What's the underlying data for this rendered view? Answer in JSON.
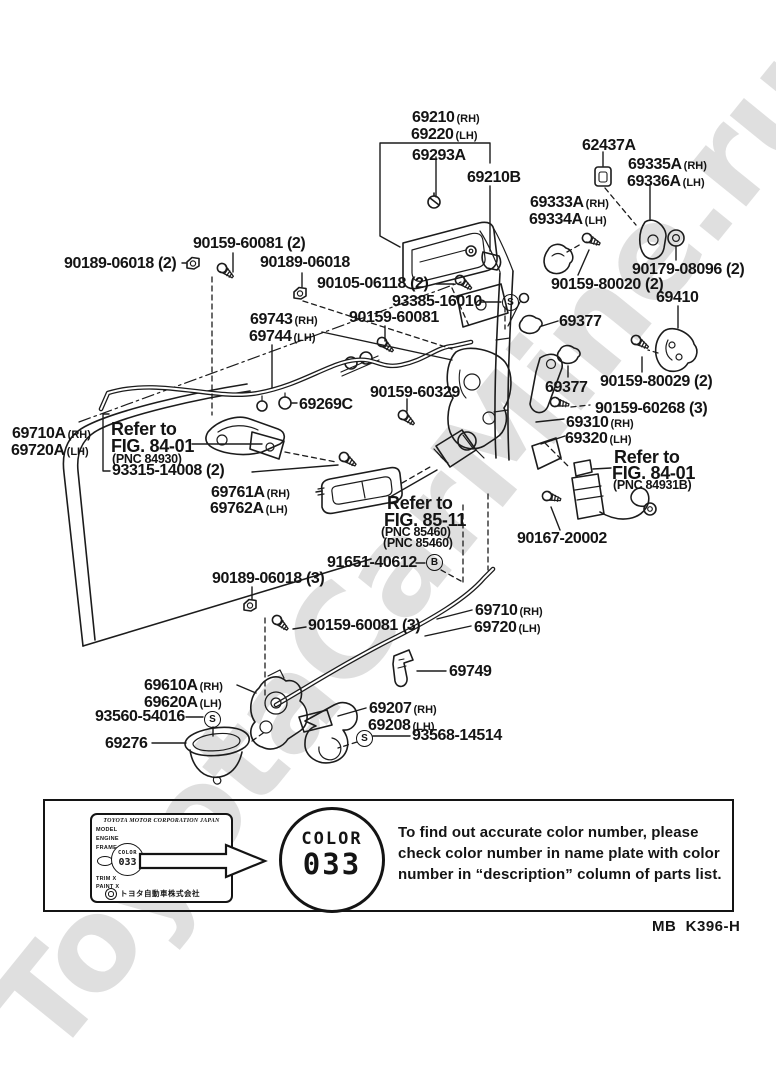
{
  "watermark": "ToyotaCarMine.ru",
  "footer_code": "MB  K396-H",
  "marks": {
    "s": "S",
    "b": "B"
  },
  "labels": [
    {
      "t": "69210",
      "s": "(RH)"
    },
    {
      "t": "69220",
      "s": "(LH)"
    },
    {
      "t": "69293A",
      "s": ""
    },
    {
      "t": "69210B",
      "s": ""
    },
    {
      "t": "62437A",
      "s": ""
    },
    {
      "t": "69335A",
      "s": "(RH)"
    },
    {
      "t": "69336A",
      "s": "(LH)"
    },
    {
      "t": "69333A",
      "s": "(RH)"
    },
    {
      "t": "69334A",
      "s": "(LH)"
    },
    {
      "t": "90179-08096 (2)",
      "s": ""
    },
    {
      "t": "90159-80020 (2)",
      "s": ""
    },
    {
      "t": "69410",
      "s": ""
    },
    {
      "t": "90189-06018 (2)",
      "s": ""
    },
    {
      "t": "90159-60081 (2)",
      "s": ""
    },
    {
      "t": "90189-06018",
      "s": ""
    },
    {
      "t": "90105-06118 (2)",
      "s": ""
    },
    {
      "t": "93385-16010",
      "s": ""
    },
    {
      "t": "69743",
      "s": "(RH)"
    },
    {
      "t": "69744",
      "s": "(LH)"
    },
    {
      "t": "90159-60081",
      "s": ""
    },
    {
      "t": "69377",
      "s": ""
    },
    {
      "t": "90159-80029 (2)",
      "s": ""
    },
    {
      "t": "69377",
      "s": ""
    },
    {
      "t": "90159-60268 (3)",
      "s": ""
    },
    {
      "t": "69310",
      "s": "(RH)"
    },
    {
      "t": "69320",
      "s": "(LH)"
    },
    {
      "t": "90159-60329",
      "s": ""
    },
    {
      "t": "69269C",
      "s": ""
    },
    {
      "t": "69710A",
      "s": "(RH)"
    },
    {
      "t": "69720A",
      "s": "(LH)"
    },
    {
      "t": "93315-14008 (2)",
      "s": ""
    },
    {
      "t": "69761A",
      "s": "(RH)"
    },
    {
      "t": "69762A",
      "s": "(LH)"
    },
    {
      "t": "90167-20002",
      "s": ""
    },
    {
      "t": "91651-40612",
      "s": ""
    },
    {
      "t": "90189-06018 (3)",
      "s": ""
    },
    {
      "t": "69710",
      "s": "(RH)"
    },
    {
      "t": "69720",
      "s": "(LH)"
    },
    {
      "t": "90159-60081 (3)",
      "s": ""
    },
    {
      "t": "69749",
      "s": ""
    },
    {
      "t": "69610A",
      "s": "(RH)"
    },
    {
      "t": "69620A",
      "s": "(LH)"
    },
    {
      "t": "93560-54016",
      "s": ""
    },
    {
      "t": "69207",
      "s": "(RH)"
    },
    {
      "t": "69208",
      "s": "(LH)"
    },
    {
      "t": "93568-14514",
      "s": ""
    },
    {
      "t": "69276",
      "s": ""
    }
  ],
  "refs": {
    "a": [
      "Refer to",
      "FIG. 84-01",
      "(PNC 84930)"
    ],
    "b": [
      "Refer to",
      "FIG. 85-11",
      "(PNC 85460)",
      "(PNC 85460)"
    ],
    "c": [
      "Refer to",
      "FIG. 84-01",
      "(PNC 84931B)"
    ]
  },
  "panel": {
    "plate": {
      "header": "TOYOTA MOTOR CORPORATION JAPAN",
      "model": "MODEL",
      "engine": "ENGINE",
      "frame": "FRAME",
      "trim": "TRIM X",
      "paint": "PAINT X",
      "color_word": "COLOR",
      "color_code": "033",
      "maker": "トヨタ自動車株式会社"
    },
    "badge": {
      "word": "COLOR",
      "code": "033"
    },
    "note": [
      "To find out accurate color number, please",
      "check color number in name plate with color",
      "number in “description” column of parts list."
    ]
  }
}
